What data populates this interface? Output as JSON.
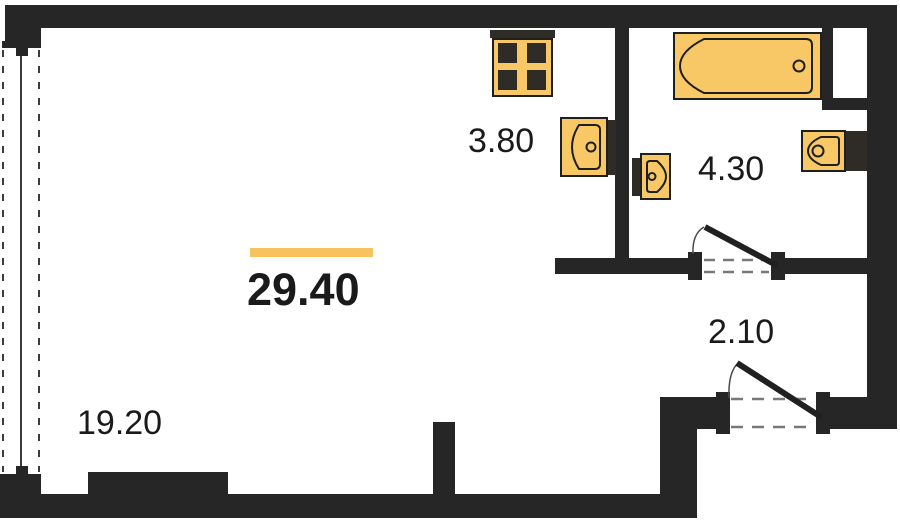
{
  "plan": {
    "type": "studio-apartment-floor-plan",
    "total": {
      "label": "29.40"
    },
    "rooms": [
      {
        "id": "living-room",
        "label": "19.20"
      },
      {
        "id": "kitchen",
        "label": "3.80"
      },
      {
        "id": "bathroom",
        "label": "4.30"
      },
      {
        "id": "hallway",
        "label": "2.10"
      }
    ],
    "fixtures": [
      {
        "id": "stove",
        "icon": "stove-icon"
      },
      {
        "id": "kitchen-sink",
        "icon": "sink-icon"
      },
      {
        "id": "washbasin",
        "icon": "washbasin-icon"
      },
      {
        "id": "bathtub",
        "icon": "bathtub-icon"
      },
      {
        "id": "toilet",
        "icon": "toilet-icon"
      }
    ],
    "doors": [
      {
        "id": "bathroom-door"
      },
      {
        "id": "entrance-door"
      }
    ],
    "window": {
      "id": "balcony-glazing"
    },
    "colors": {
      "wall": "#262626",
      "fixture_fill": "#F8C867",
      "fixture_dark": "#2F2B27",
      "outline": "#1F1F1F",
      "accent_bar": "#F6C35F",
      "text": "#1A1A1A",
      "dash": "#787878"
    }
  }
}
